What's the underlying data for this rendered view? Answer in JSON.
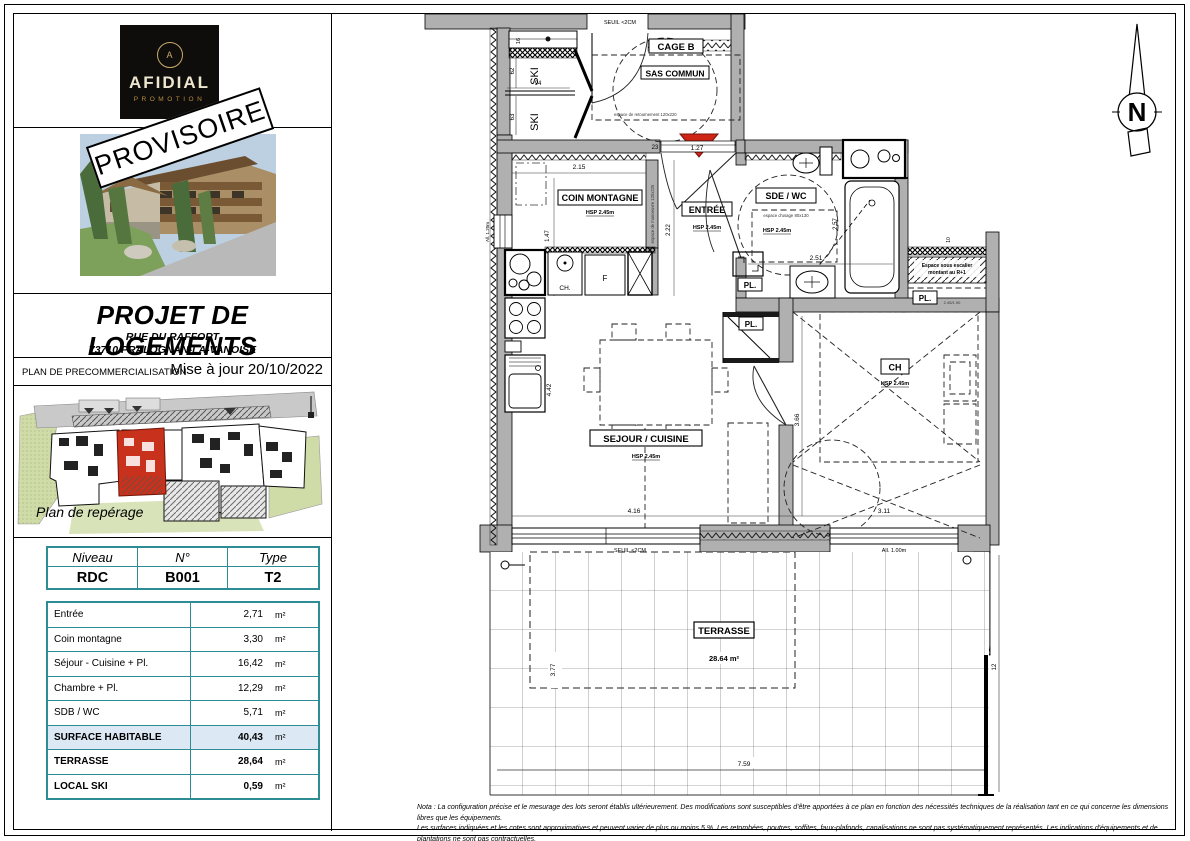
{
  "colors": {
    "accent_teal": "#2e8c94",
    "highlight_blue": "#dce9f5",
    "unit_red": "#c8311b",
    "wall_gray": "#b0b0b0",
    "logo_gold": "#b98d3f"
  },
  "logo": {
    "brand": "AFIDIAL",
    "sub": "PROMOTION",
    "monogram": "A"
  },
  "stamp": {
    "text": "PROVISOIRE"
  },
  "title_block": {
    "title": "PROJET DE LOGEMENTS",
    "address1": "RUE DU RAFFORT",
    "address2": "73710 PRALOGNAN-LA-VANOISE"
  },
  "status_bar": {
    "left": "PLAN DE PRECOMMERCIALISATION",
    "right": "Mise à jour 20/10/2022"
  },
  "site_plan": {
    "caption": "Plan de repérage"
  },
  "unit_table": {
    "headers": [
      "Niveau",
      "N°",
      "Type"
    ],
    "values": [
      "RDC",
      "B001",
      "T2"
    ]
  },
  "surface_table": {
    "rows": [
      {
        "label": "Entrée",
        "value": "2,71",
        "unit": "m²"
      },
      {
        "label": "Coin montagne",
        "value": "3,30",
        "unit": "m²"
      },
      {
        "label": "Séjour - Cuisine + Pl.",
        "value": "16,42",
        "unit": "m²"
      },
      {
        "label": "Chambre + Pl.",
        "value": "12,29",
        "unit": "m²"
      },
      {
        "label": "SDB / WC",
        "value": "5,71",
        "unit": "m²"
      },
      {
        "label": "SURFACE HABITABLE",
        "value": "40,43",
        "unit": "m²"
      },
      {
        "label": "TERRASSE",
        "value": "28,64",
        "unit": "m²"
      },
      {
        "label": "LOCAL SKI",
        "value": "0,59",
        "unit": "m²"
      }
    ]
  },
  "plan": {
    "labels": {
      "seuil": "SEUIL <2CM",
      "cage_b": "CAGE B",
      "sas_commun": "SAS COMMUN",
      "ski": "SKI",
      "coin_montagne": "COIN MONTAGNE",
      "entree": "ENTRÉE",
      "sde_wc": "SDE / WC",
      "usage": "espace d'usage 80x130",
      "manoeuvre": "espace de manoeuvre 120x225",
      "retournement": "espace de retournement 120x220",
      "hsp": "HSP 2.45m",
      "ch_room": "CH",
      "ch_appliance": "CH.",
      "fridge": "F",
      "pl": "PL.",
      "escalier_1": "Espace sous escalier",
      "escalier_2": "montant au R+1",
      "pl_dims": "2.45/1.90",
      "sejour": "SEJOUR / CUISINE",
      "terrasse": "TERRASSE",
      "terrasse_area": "28.64 m²",
      "all_100": "All. 1.00m",
      "all_120": "All. 1.20m",
      "north": "N"
    },
    "dims": {
      "d16": "16",
      "d62": "62",
      "d63": "63",
      "d94": "94",
      "d215": "2.15",
      "d23": "23",
      "d127": "1.27",
      "d147": "1.47",
      "d222": "2.22",
      "d257": "2.57",
      "d251": "2.51",
      "d442": "4.42",
      "d416": "4.16",
      "d366": "3.66",
      "d311": "3.11",
      "d377": "3.77",
      "d759": "7.59",
      "d12": "12",
      "d10": "10"
    }
  },
  "footnote": {
    "line1": "Nota : La configuration précise et le mesurage des lots seront établis ultérieurement. Des modifications sont susceptibles d'être apportées à ce plan en fonction des nécessités techniques de la réalisation tant en ce qui concerne les dimensions libres que les équipements.",
    "line2": "Les surfaces indiquées et les cotes sont approximatives et peuvent varier de plus ou moins 5 %. Les retombées, poutres, soffites, faux-plafonds, canalisations ne sont pas systématiquement représentés. Les indications d'équipements et de plantations ne sont pas contractuelles."
  }
}
